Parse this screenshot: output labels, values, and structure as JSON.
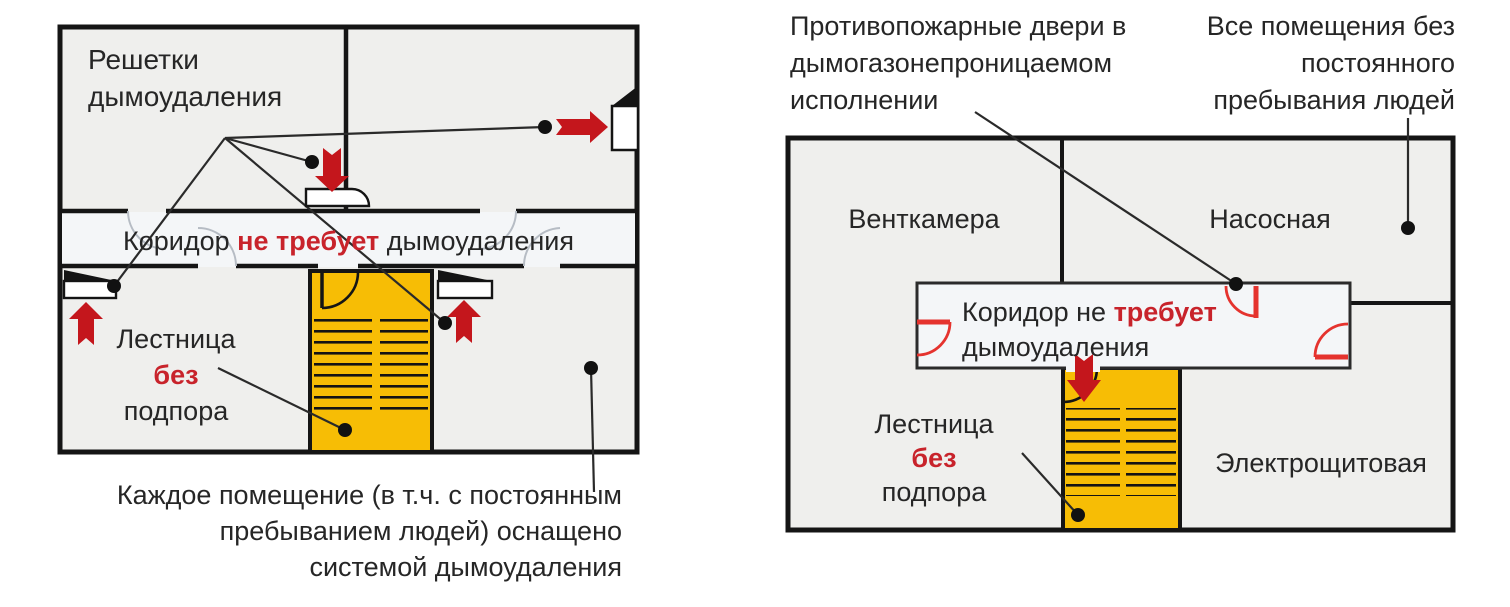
{
  "colors": {
    "wall": "#151515",
    "room": "#efefed",
    "corridor": "#f4f6f8",
    "stairs": "#f7bd05",
    "arrow-red": "#c4161c",
    "text-red": "#c8232b",
    "door-red": "#e5332e",
    "ink": "#262626"
  },
  "left_plan": {
    "grilles_label": {
      "line1": "Решетки",
      "line2": "дымоудаления"
    },
    "corridor": {
      "prefix": "Коридор ",
      "highlight": "не требует",
      "suffix": " дымоудаления"
    },
    "stairs_label": {
      "line1": "Лестница",
      "highlight": "без",
      "line3": "подпора"
    },
    "caption": {
      "line1": "Каждое помещение (в т.ч. с постоянным",
      "line2": "пребыванием людей) оснащено",
      "line3": "системой дымоудаления"
    }
  },
  "right_plan": {
    "caption_doors": {
      "line1": "Противопожарные двери в",
      "line2": "дымогазонепроницаемом",
      "line3": "исполнении"
    },
    "caption_rooms": {
      "line1": "Все помещения без",
      "line2": "постоянного",
      "line3": "пребывания людей"
    },
    "rooms": {
      "vent": "Венткамера",
      "pump": "Насосная",
      "electrical": "Электрощитовая"
    },
    "corridor": {
      "prefix": "Коридор не ",
      "highlight": "требует",
      "line2": "дымоудаления"
    },
    "stairs_label": {
      "line1": "Лестница",
      "highlight": "без",
      "line3": "подпора"
    }
  }
}
